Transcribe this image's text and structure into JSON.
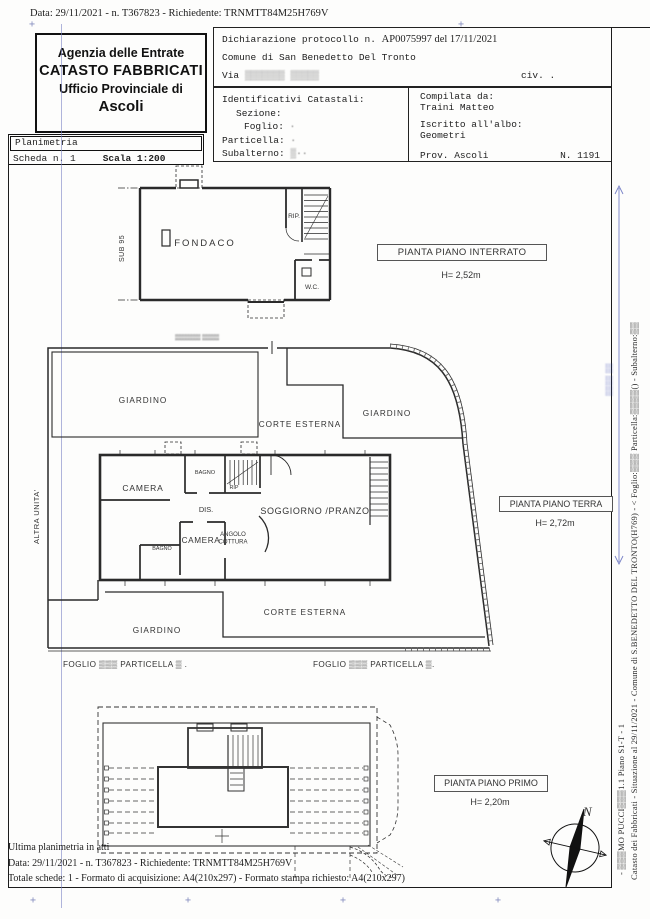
{
  "doc": {
    "scan_header": "Data: 29/11/2021 - n. T367823 - Richiedente: TRNMTT84M25H769V",
    "agency_box": {
      "l1": "Agenzia delle Entrate",
      "l2": "CATASTO FABBRICATI",
      "l3": "Ufficio Provinciale di",
      "l4": "Ascoli"
    },
    "declaration_box": {
      "protocol_label": "Dichiarazione protocollo n.",
      "protocol_value": "AP0075997 del  17/11/2021",
      "comune": "Comune di San Benedetto Del Tronto",
      "via_label": "Via",
      "via_redacted": "▒▒▒▒▒▒▒ ▒▒▒▒▒",
      "civ": "civ. ."
    },
    "cadastral_box": {
      "title": "Identificativi Catastali:",
      "sezione": "Sezione:",
      "foglio": "Foglio:",
      "foglio_val": "·",
      "particella": "Particella:",
      "particella_val": "·",
      "subalterno": "Subalterno:",
      "subalterno_val": "▒··",
      "compilata_label": "Compilata da:",
      "compilata_name": "Traini Matteo",
      "albo_label": "Iscritto all'albo:",
      "albo_name": "Geometri",
      "prov": "Prov. Ascoli",
      "albo_num": "N. 1191"
    },
    "sheet_box": {
      "title": "Planimetria",
      "scheda": "Scheda n. 1",
      "scala": "Scala 1:200"
    },
    "margin_text": {
      "line1": "Catasto dei Fabbricati - Situazione al 29/11/2021 - Comune di S.BENEDETTO DEL TRONTO(H769) - <  Foglio:▒▒▒  Particella:▒▒▒▒() - Subalterno:▒▒",
      "line2": "- ▒▒▒MO PUCCI▒▒▒1.1 Piano S1-T - 1"
    },
    "footer": {
      "ultima": "Ultima planimetria in atti",
      "data_line": "Data: 29/11/2021 - n. T367823 - Richiedente: TRNMTT84M25H769V",
      "totale_line": "Totale schede: 1 - Formato di acquisizione: A4(210x297)  - Formato stampa richiesto: A4(210x297)"
    }
  },
  "plans": {
    "interrato": {
      "title": "PIANTA PIANO INTERRATO",
      "height_label": "H= 2,52m",
      "sub": "SUB 95",
      "fondaco": "FONDACO",
      "rip": "RIP.",
      "wc": "W.C."
    },
    "terra": {
      "title": "PIANTA PIANO TERRA",
      "height_label": "H= 2,72m",
      "street_redacted": "▒▒▒▒▒▒ ▒▒▒▒",
      "giardino_tl": "GIARDINO",
      "giardino_r": "GIARDINO",
      "giardino_b": "GIARDINO",
      "corte_top": "CORTE ESTERNA",
      "corte_bottom": "CORTE ESTERNA",
      "camera1": "CAMERA",
      "camera2": "CAMERA",
      "bagno1": "BAGNO",
      "bagno2": "BAGNO",
      "rip": "RIP",
      "dis": "DIS.",
      "angolo1": "ANGOLO",
      "angolo2": "COTTURA",
      "soggiorno": "SOGGIORNO /PRANZO",
      "altra_unita": "ALTRA UNITA'",
      "foglio_left": "FOGLIO ▒▒▒ PARTICELLA ▒ .",
      "foglio_right": "FOGLIO ▒▒▒ PARTICELLA ▒."
    },
    "primo": {
      "title": "PIANTA PIANO PRIMO",
      "height_label": "H= 2,20m"
    },
    "compass": {
      "north": "N"
    }
  }
}
